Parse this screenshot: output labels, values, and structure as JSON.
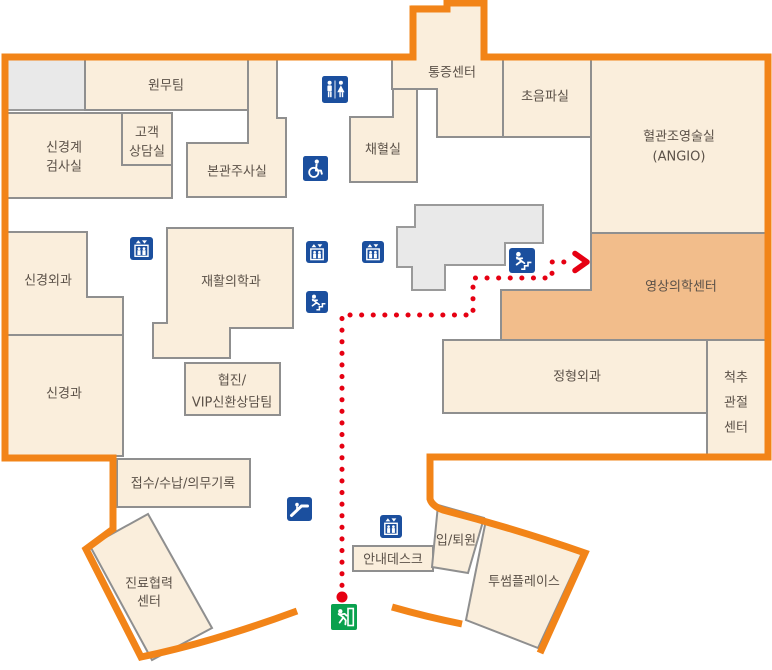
{
  "map": {
    "rooms": {
      "wonmu": {
        "label": "원무팀"
      },
      "singyeonggye": {
        "lines": [
          "신경계",
          "검사실"
        ]
      },
      "gogaek": {
        "lines": [
          "고객",
          "상담실"
        ]
      },
      "bongwan": {
        "label": "본관주사실"
      },
      "tongjeung": {
        "label": "통증센터"
      },
      "chaehyeol": {
        "label": "채혈실"
      },
      "choeumpa": {
        "label": "초음파실"
      },
      "angio": {
        "lines": [
          "혈관조영술실",
          "(ANGIO)"
        ]
      },
      "yeongsang": {
        "label": "영상의학센터",
        "highlighted": true
      },
      "jeonghyeong": {
        "label": "정형외과"
      },
      "cheokchu": {
        "lines": [
          "척추",
          "관절",
          "센터"
        ]
      },
      "singyeongoegwa": {
        "label": "신경외과"
      },
      "jaehwal": {
        "label": "재활의학과"
      },
      "singyeonggwa": {
        "label": "신경과"
      },
      "hyeopjin": {
        "lines": [
          "협진/",
          "VIP신환상담팀"
        ]
      },
      "jeopsu": {
        "label": "접수/수납/의무기록"
      },
      "jinryo": {
        "lines": [
          "진료협력",
          "센터"
        ]
      },
      "annae": {
        "label": "안내데스크"
      },
      "iptoewon": {
        "label": "입/퇴원"
      },
      "twosome": {
        "label": "투썸플레이스"
      }
    },
    "icon_types": [
      "restroom",
      "wheelchair",
      "elevator",
      "stairs",
      "escalator",
      "emergency-exit"
    ],
    "colors": {
      "outline_orange": "#F28418",
      "room_fill": "#FAEEDC",
      "room_border": "#8F8F8F",
      "highlight_fill": "#F2BD8B",
      "gray_fill": "#E9E9E9",
      "icon_blue": "#1B4F9E",
      "exit_green": "#0AA14E",
      "route_red": "#E60012",
      "label_text": "#5B5148"
    },
    "route": {
      "points": [
        [
          342,
          597
        ],
        [
          342,
          315
        ],
        [
          473,
          315
        ],
        [
          473,
          278
        ],
        [
          552,
          278
        ],
        [
          552,
          262
        ],
        [
          571,
          262
        ]
      ],
      "start": [
        342,
        597
      ],
      "arrow_tip": [
        587,
        262
      ]
    }
  }
}
